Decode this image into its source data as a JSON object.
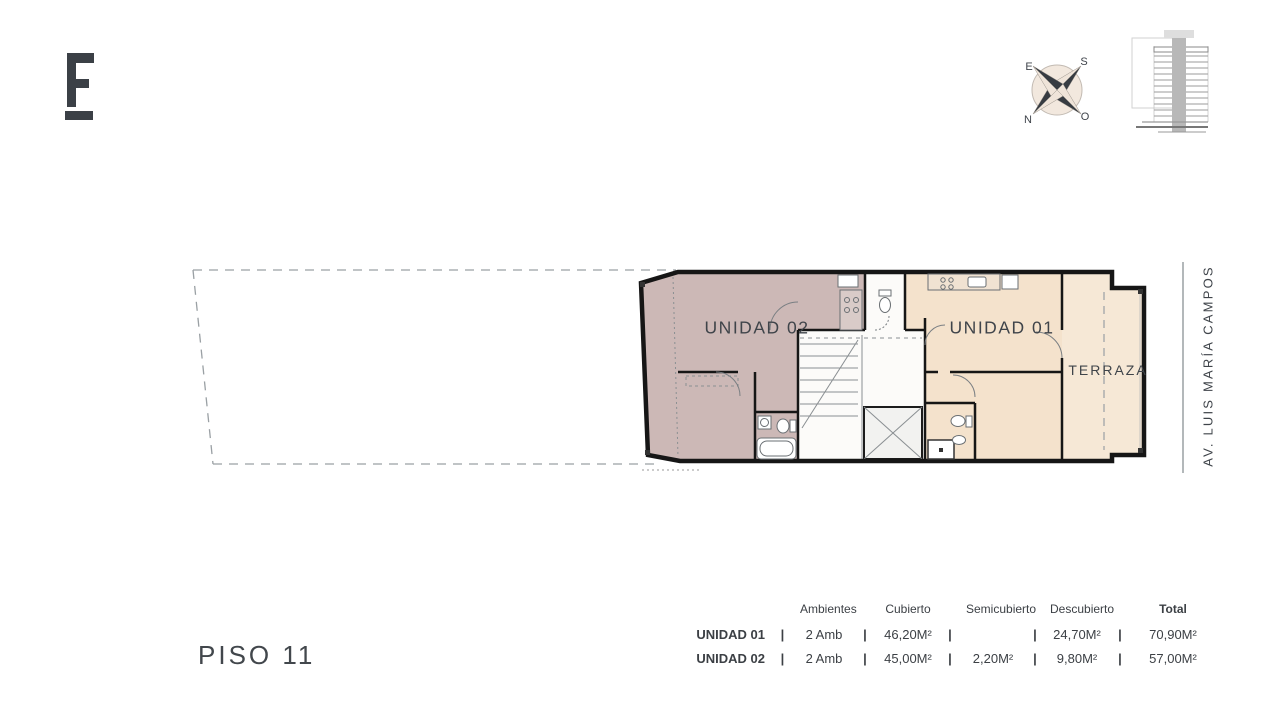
{
  "logo": {
    "letter": "E"
  },
  "compass": {
    "e": "E",
    "s": "S",
    "n": "N",
    "o": "O"
  },
  "plan": {
    "unit_02_label": "UNIDAD 02",
    "unit_01_label": "UNIDAD 01",
    "terrace_label": "TERRAZA",
    "street_label": "AV. LUIS MARÍA CAMPOS",
    "colors": {
      "unit_02_fill": "#ccb8b6",
      "unit_01_fill": "#f4e2cc",
      "terrace_fill": "#f6e8d6",
      "core_fill": "#fcfbf9",
      "wall": "#161616",
      "dashed_line": "#9aa0a4"
    }
  },
  "floor": {
    "title": "PISO 11"
  },
  "area_table": {
    "separator": "|",
    "columns": [
      "Ambientes",
      "Cubierto",
      "Semicubierto",
      "Descubierto",
      "Total"
    ],
    "rows": [
      {
        "name": "UNIDAD 01",
        "ambientes": "2 Amb",
        "cubierto": "46,20M²",
        "semicubierto": "",
        "descubierto": "24,70M²",
        "total": "70,90M²"
      },
      {
        "name": "UNIDAD 02",
        "ambientes": "2 Amb",
        "cubierto": "45,00M²",
        "semicubierto": "2,20M²",
        "descubierto": "9,80M²",
        "total": "57,00M²"
      }
    ]
  }
}
